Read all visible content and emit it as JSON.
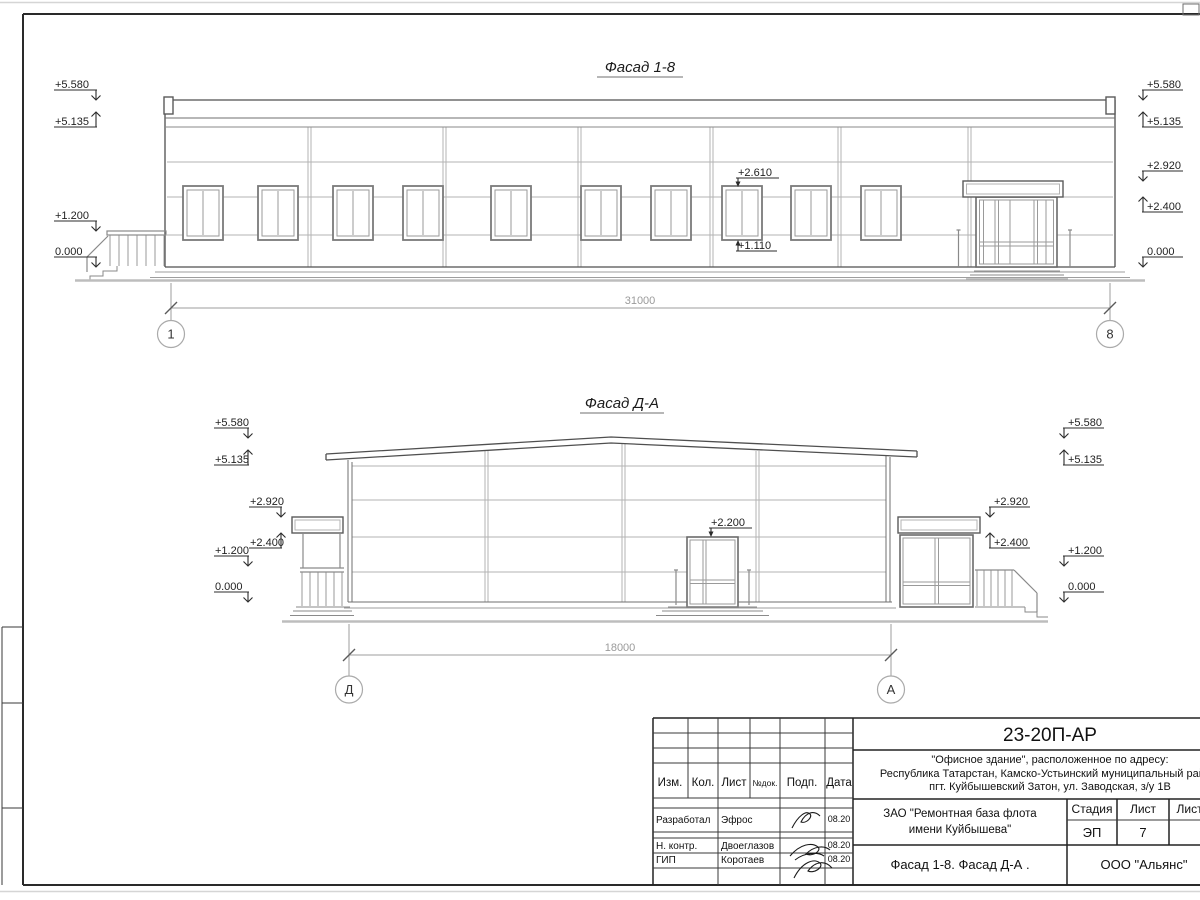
{
  "facade_1_8": {
    "title": "Фасад 1-8",
    "dimension": "31000",
    "axis_left": "1",
    "axis_right": "8",
    "marks_left": [
      "+5.580",
      "+5.135",
      "+1.200",
      "0.000"
    ],
    "marks_right": [
      "+5.580",
      "+5.135",
      "+2.920",
      "+2.400",
      "0.000"
    ],
    "window_top_mark": "+2.610",
    "window_bottom_mark": "+1.110"
  },
  "facade_d_a": {
    "title": "Фасад Д-А",
    "dimension": "18000",
    "axis_left": "Д",
    "axis_right": "А",
    "marks_left": [
      "+5.580",
      "+5.135",
      "+2.920",
      "+2.400",
      "+1.200",
      "0.000"
    ],
    "marks_right": [
      "+5.580",
      "+5.135",
      "+2.920",
      "+2.400",
      "+1.200",
      "0.000"
    ],
    "door_top_mark": "+2.200"
  },
  "title_block": {
    "doc_code": "23-20П-АР",
    "address_line1": "\"Офисное здание\", расположенное по адресу:",
    "address_line2": "Республика Татарстан, Камско-Устьинский муниципальный район,",
    "address_line3": "пгт. Куйбышевский Затон, ул. Заводская, з/у 1В",
    "columns": {
      "izm": "Изм.",
      "kol": "Кол.",
      "list": "Лист",
      "ndok": "№док.",
      "podp": "Подп.",
      "data": "Дата"
    },
    "rows": [
      {
        "role": "Разработал",
        "name": "Эфрос",
        "date": "08.20"
      },
      {
        "role": "Н. контр.",
        "name": "Двоеглазов",
        "date": "08.20"
      },
      {
        "role": "ГИП",
        "name": "Коротаев",
        "date": "08.20"
      }
    ],
    "client_line1": "ЗАО \"Ремонтная база флота",
    "client_line2": "имени Куйбышева\"",
    "stage_label": "Стадия",
    "sheet_label": "Лист",
    "sheets_label": "Листов",
    "stage_value": "ЭП",
    "sheet_value": "7",
    "sheet_title": "Фасад 1-8. Фасад Д-А .",
    "company": "ООО \"Альянс\""
  }
}
